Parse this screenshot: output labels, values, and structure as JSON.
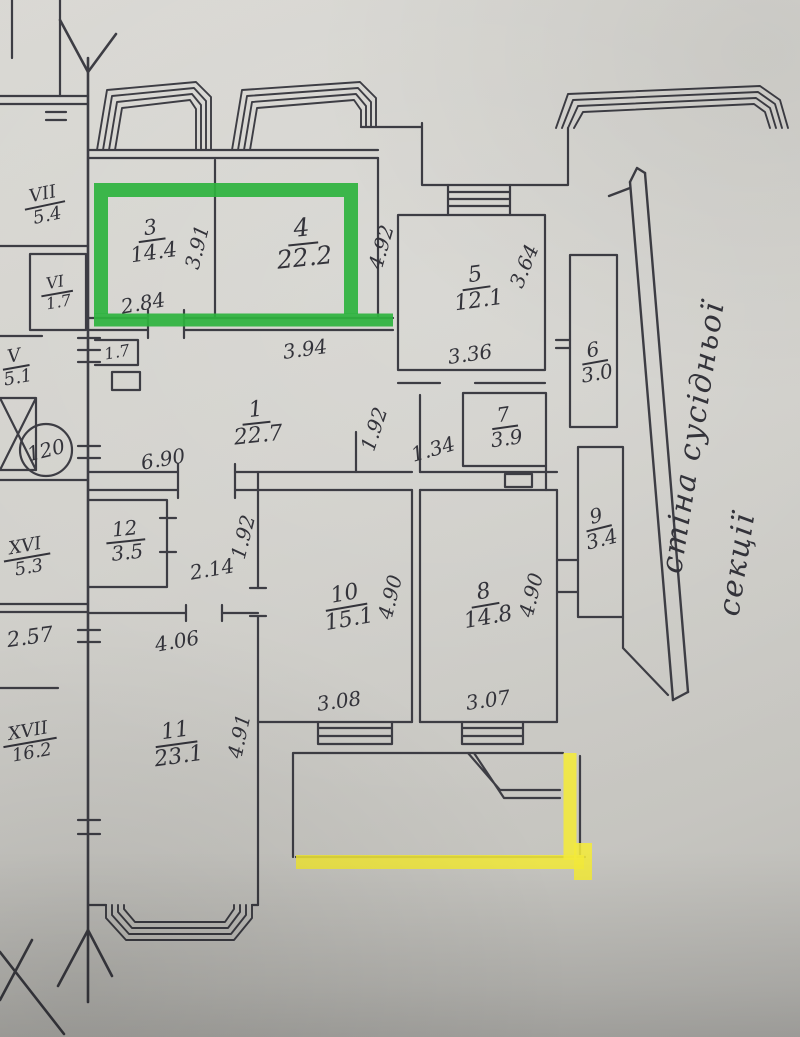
{
  "colors": {
    "paper": "#d1d0cb",
    "ink": "#3d3d44",
    "pencil": "#33333a",
    "highlight_green": "#2eb33e",
    "highlight_yellow": "#f4eb3a"
  },
  "apartment": {
    "circled_number": "120"
  },
  "note": {
    "line1": "стіна сусідньої",
    "line2": "секції"
  },
  "rooms": {
    "r1": {
      "number": "1",
      "area": "22.7"
    },
    "r3": {
      "number": "3",
      "area": "14.4"
    },
    "r4": {
      "number": "4",
      "area": "22.2"
    },
    "r5": {
      "number": "5",
      "area": "12.1"
    },
    "r6": {
      "number": "6",
      "area": "3.0"
    },
    "r7": {
      "number": "7",
      "area": "3.9"
    },
    "r8": {
      "number": "8",
      "area": "14.8"
    },
    "r9": {
      "number": "9",
      "area": "3.4"
    },
    "r10": {
      "number": "10",
      "area": "15.1"
    },
    "r11": {
      "number": "11",
      "area": "23.1"
    },
    "r12": {
      "number": "12",
      "area": "3.5"
    }
  },
  "adjacent_units": {
    "u7": {
      "number": "VII",
      "area": "5.4"
    },
    "u6": {
      "number": "VI",
      "area": "1.7"
    },
    "u5": {
      "number": "V",
      "area": "5.1"
    },
    "u16": {
      "number": "XVI",
      "area": "5.3"
    },
    "u17": {
      "number": "XVII",
      "area": "16.2"
    }
  },
  "dimensions": {
    "d391": "3.91",
    "d284": "2.84",
    "d492": "4.92",
    "d394": "3.94",
    "d364": "3.64",
    "d336": "3.36",
    "d17": "1.7",
    "d690": "6.90",
    "d192a": "1.92",
    "d134": "1.34",
    "d192b": "1.92",
    "d214": "2.14",
    "d490a": "4.90",
    "d308": "3.08",
    "d490b": "4.90",
    "d307": "3.07",
    "d406": "4.06",
    "d491": "4.91",
    "d257": "2.57"
  }
}
